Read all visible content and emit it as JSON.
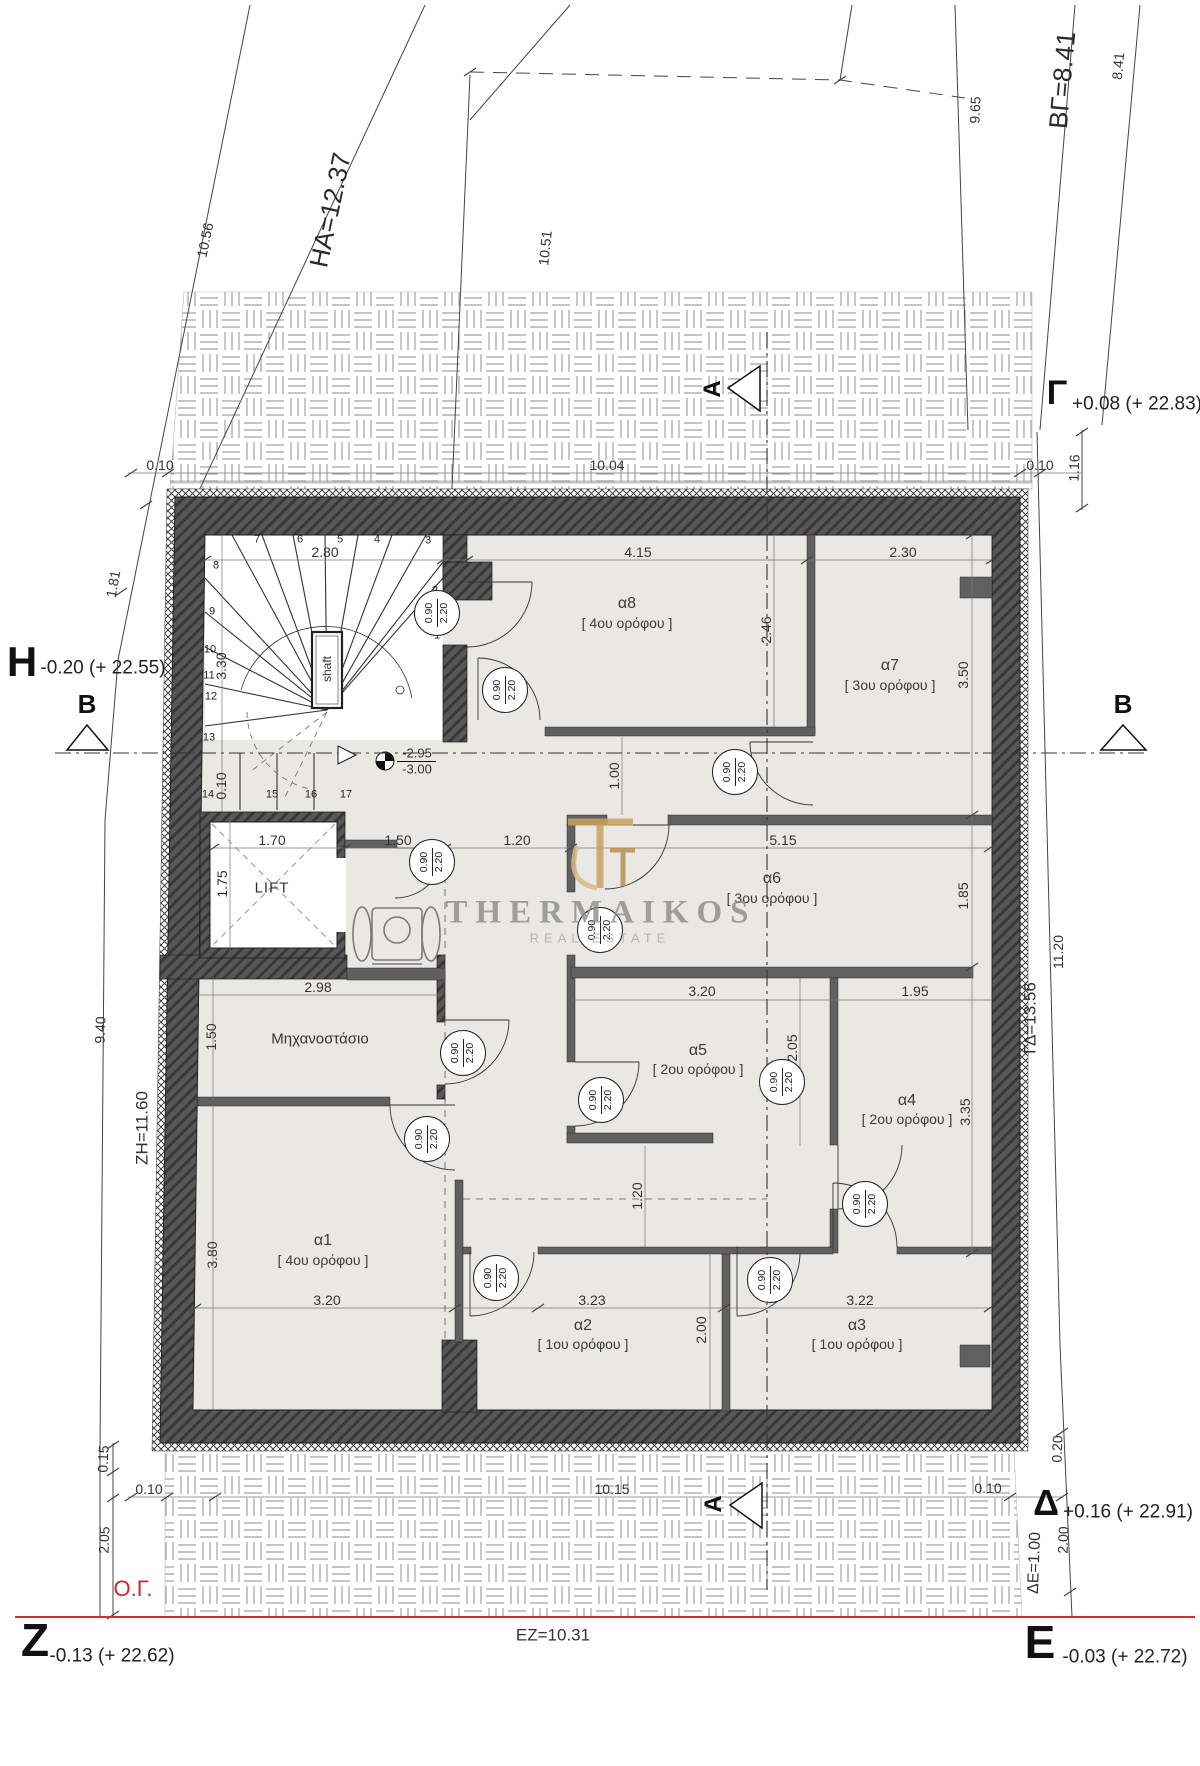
{
  "site": {
    "top_dims": {
      "d1056": "10.56",
      "ha": "HA=12.37",
      "d1051": "10.51",
      "d965": "9.65",
      "bg": "ΒΓ=8.41",
      "d841": "8.41",
      "t010l": "0.10",
      "t1004": "10.04",
      "t010r": "0.10",
      "r116": "1.16"
    },
    "left_dims": {
      "d181": "1.81",
      "d940": "9.40",
      "zh": "ΖΗ=11.60",
      "d015": "0.15",
      "d205": "2.05",
      "b010": "0.10"
    },
    "right_dims": {
      "gd": "ΓΔ=13.56",
      "d1120": "11.20",
      "d020": "0.20",
      "d200": "2.00",
      "de": "ΔΕ=1.00",
      "b010": "0.10"
    },
    "bottom_dims": {
      "d1015": "10.15",
      "ez": "ΕΖ=10.31",
      "og": "Ο.Γ."
    },
    "corners": {
      "gamma": {
        "letter": "Γ",
        "level": "+0.08 (+ 22.83)"
      },
      "eta": {
        "letter": "Η",
        "level": "-0.20 (+ 22.55)"
      },
      "delta": {
        "letter": "Δ",
        "level": "+0.16 (+ 22.91)"
      },
      "epsilon": {
        "letter": "Ε",
        "level": "-0.03 (+ 22.72)"
      },
      "zeta": {
        "letter": "Ζ",
        "level": "-0.13 (+ 22.62)"
      }
    },
    "sections": {
      "a": "A",
      "b": "B"
    }
  },
  "rooms": [
    {
      "id": "α8",
      "floor": "[ 4ου ορόφου ]",
      "w": "4.15",
      "cl": "2.46"
    },
    {
      "id": "α7",
      "floor": "[ 3ου ορόφου ]",
      "w": "2.30",
      "h": "3.50"
    },
    {
      "id": "α6",
      "floor": "[ 3ου ορόφου ]",
      "w": "5.15",
      "h": "1.85"
    },
    {
      "id": "α5",
      "floor": "[ 2ου ορόφου ]",
      "w": "3.20",
      "h": "2.05"
    },
    {
      "id": "α4",
      "floor": "[ 2ου ορόφου ]",
      "w": "1.95",
      "h": "3.35"
    },
    {
      "id": "α1",
      "floor": "[ 4ου ορόφου ]",
      "w": "3.20",
      "h": "3.80"
    },
    {
      "id": "α2",
      "floor": "[ 1ου ορόφου ]",
      "w": "3.23",
      "h": "2.00"
    },
    {
      "id": "α3",
      "floor": "[ 1ου ορόφου ]",
      "w": "3.22"
    }
  ],
  "core": {
    "stair_width": "2.80",
    "stair_height": "3.30",
    "stair_010": "0.10",
    "shaft": "shaft",
    "level_upper": "-2.95",
    "level_lower": "-3.00",
    "lift": "LIFT",
    "lift_w": "1.70",
    "lift_h": "1.75",
    "landing_150": "1.50",
    "landing_120": "1.20",
    "machine_room": "Μηχανοστάσιο",
    "mech_w": "2.98",
    "mech_h": "1.50",
    "corridor_100": "1.00",
    "corridor_120": "1.20"
  },
  "stairs": {
    "numbers": [
      "1",
      "2",
      "3",
      "4",
      "5",
      "6",
      "7",
      "8",
      "9",
      "10",
      "11",
      "12",
      "13",
      "14",
      "15",
      "16",
      "17"
    ]
  },
  "door": {
    "w": "0.90",
    "h": "2.20"
  },
  "watermark": {
    "name": "THERMAIKOS",
    "subtitle": "REAL ESTATE"
  }
}
